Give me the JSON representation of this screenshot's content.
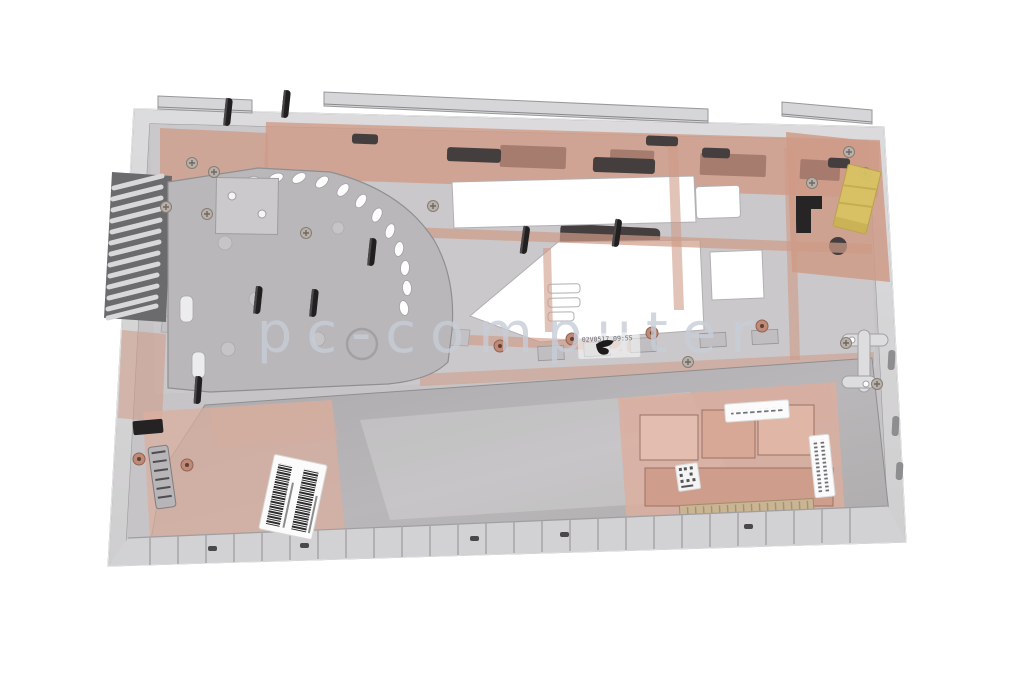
{
  "page": {
    "background_color": "#ffffff"
  },
  "photo": {
    "watermark": {
      "text": "pc-computer",
      "color": "#c7cdd8"
    },
    "date_stamp": {
      "text": "02V0517 09:55"
    },
    "colors": {
      "rim_silver": "#d6d5d7",
      "rim_edge": "#9b9a9c",
      "floor_gray": "#c6c4c6",
      "upper_gray": "#cac8ca",
      "panel_gray": "#b0aeb0",
      "plate_gray": "#b9b7b9",
      "copper": "#cf9b87",
      "copper_light": "#dcae9d",
      "copper_dark": "#9b7265",
      "slot_dark": "#443f3e",
      "rubber_black": "#211f1f",
      "kapton_yellow": "#d9c263",
      "speaker_tan": "#c9b493",
      "label_white": "#fbfbfb",
      "barcode_ink": "#2b2b2b"
    }
  }
}
